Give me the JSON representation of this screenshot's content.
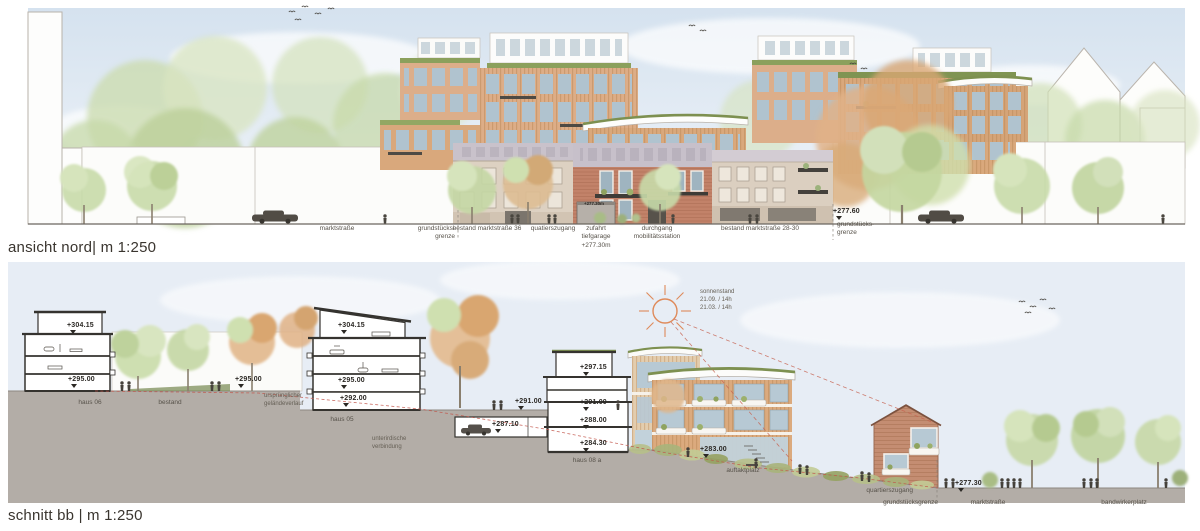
{
  "panel1": {
    "caption": "ansicht nord| m 1:250",
    "street_labels": {
      "marktstrasse": "marktstraße",
      "grenze_left": "grundstücks-\ngrenze",
      "bestand36": "bestand marktstraße 36",
      "quartierszugang": "quatierszugang",
      "zufahrt": "zufahrt\ntiefgarage\n+277.30m",
      "durchgang": "durchgang\nmobilitätsstation",
      "bestand2830": "bestand marktstraße 28-30",
      "grenze_right": "grundstücks-\ngrenze"
    },
    "markers": {
      "street_right": "+277.60",
      "garage_sign": "+277.30m"
    }
  },
  "panel2": {
    "caption": "schnitt bb | m 1:250",
    "sun_label": "sonnenstand\n21.09. / 14h\n21.03. / 14h",
    "markers": {
      "haus06_top": "+304.15",
      "haus06_ground": "+295.00",
      "bestand_ground": "+295.00",
      "haus05_top": "+304.15",
      "haus05_ground": "+295.00",
      "haus05_base": "+292.00",
      "garage_outside": "+291.00",
      "garage_level": "+287.10",
      "haus08a_top": "+297.15",
      "haus08a_l2": "+291.00",
      "haus08a_l1": "+288.00",
      "haus08a_base": "+284.30",
      "auftaktplatz": "+283.00",
      "street": "+277.30"
    },
    "labels": {
      "haus06": "haus 06",
      "bestand": "bestand",
      "gelaendeverlauf": "ursprünglicher\ngeländeverlauf",
      "haus05": "haus 05",
      "verbindung": "unterirdische\nverbindung",
      "haus08a": "haus 08 a",
      "auftaktplatz": "auftaktplatz",
      "quartierszugang": "quartierszugang",
      "grundstuecksgrenze": "grundstücksgrenze",
      "marktstrasse": "marktstraße",
      "bandwirkerplatz": "bandwirkerplatz"
    }
  },
  "colors": {
    "accent_red": "#c2554a",
    "sun_orange": "#df8a5a",
    "ground_gray": "#b3ada7",
    "green_roof": "#7d9050",
    "terracotta": "#d9a87c",
    "brick": "#c28269",
    "beige_bestand": "#ddd1c2",
    "sky_blue": "#dce7f2"
  }
}
